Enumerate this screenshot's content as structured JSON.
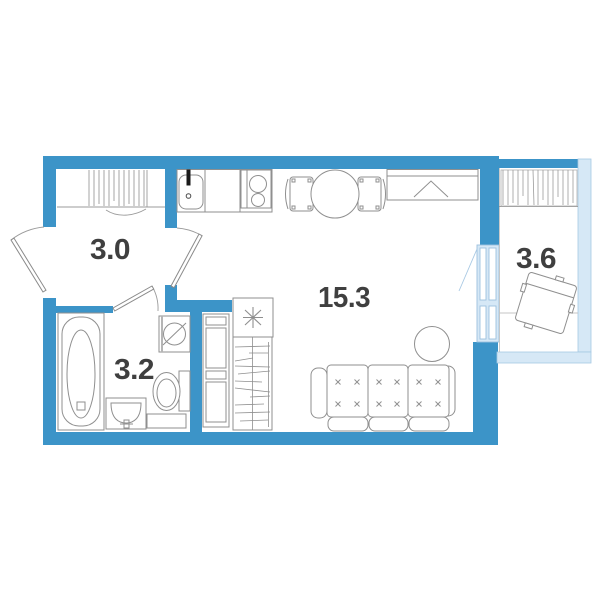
{
  "colors": {
    "wall": "#3c94c8",
    "glazing": "#d6e8f6",
    "glazing_stroke": "#a6c9e3",
    "furniture_stroke": "#8f8f8f",
    "hatch_stroke": "#9b9b9b",
    "label": "#3f3f3f"
  },
  "rooms": {
    "hall": {
      "label": "3.0"
    },
    "bathroom": {
      "label": "3.2"
    },
    "living_room": {
      "label": "15.3"
    },
    "balcony": {
      "label": "3.6"
    }
  },
  "fixtures": [
    "entrance-door",
    "hall-closet",
    "interior-door",
    "bathroom-door",
    "bathtub",
    "washing-machine",
    "toilet",
    "bathroom-sink",
    "tall-cabinet",
    "wardrobe-shelves",
    "refrigerator",
    "kitchen-counter",
    "kitchen-sink",
    "stove",
    "dining-table",
    "dining-chairs",
    "wardrobe",
    "sofa",
    "side-table",
    "balcony-window",
    "balcony-door",
    "drying-rack",
    "armchair"
  ]
}
